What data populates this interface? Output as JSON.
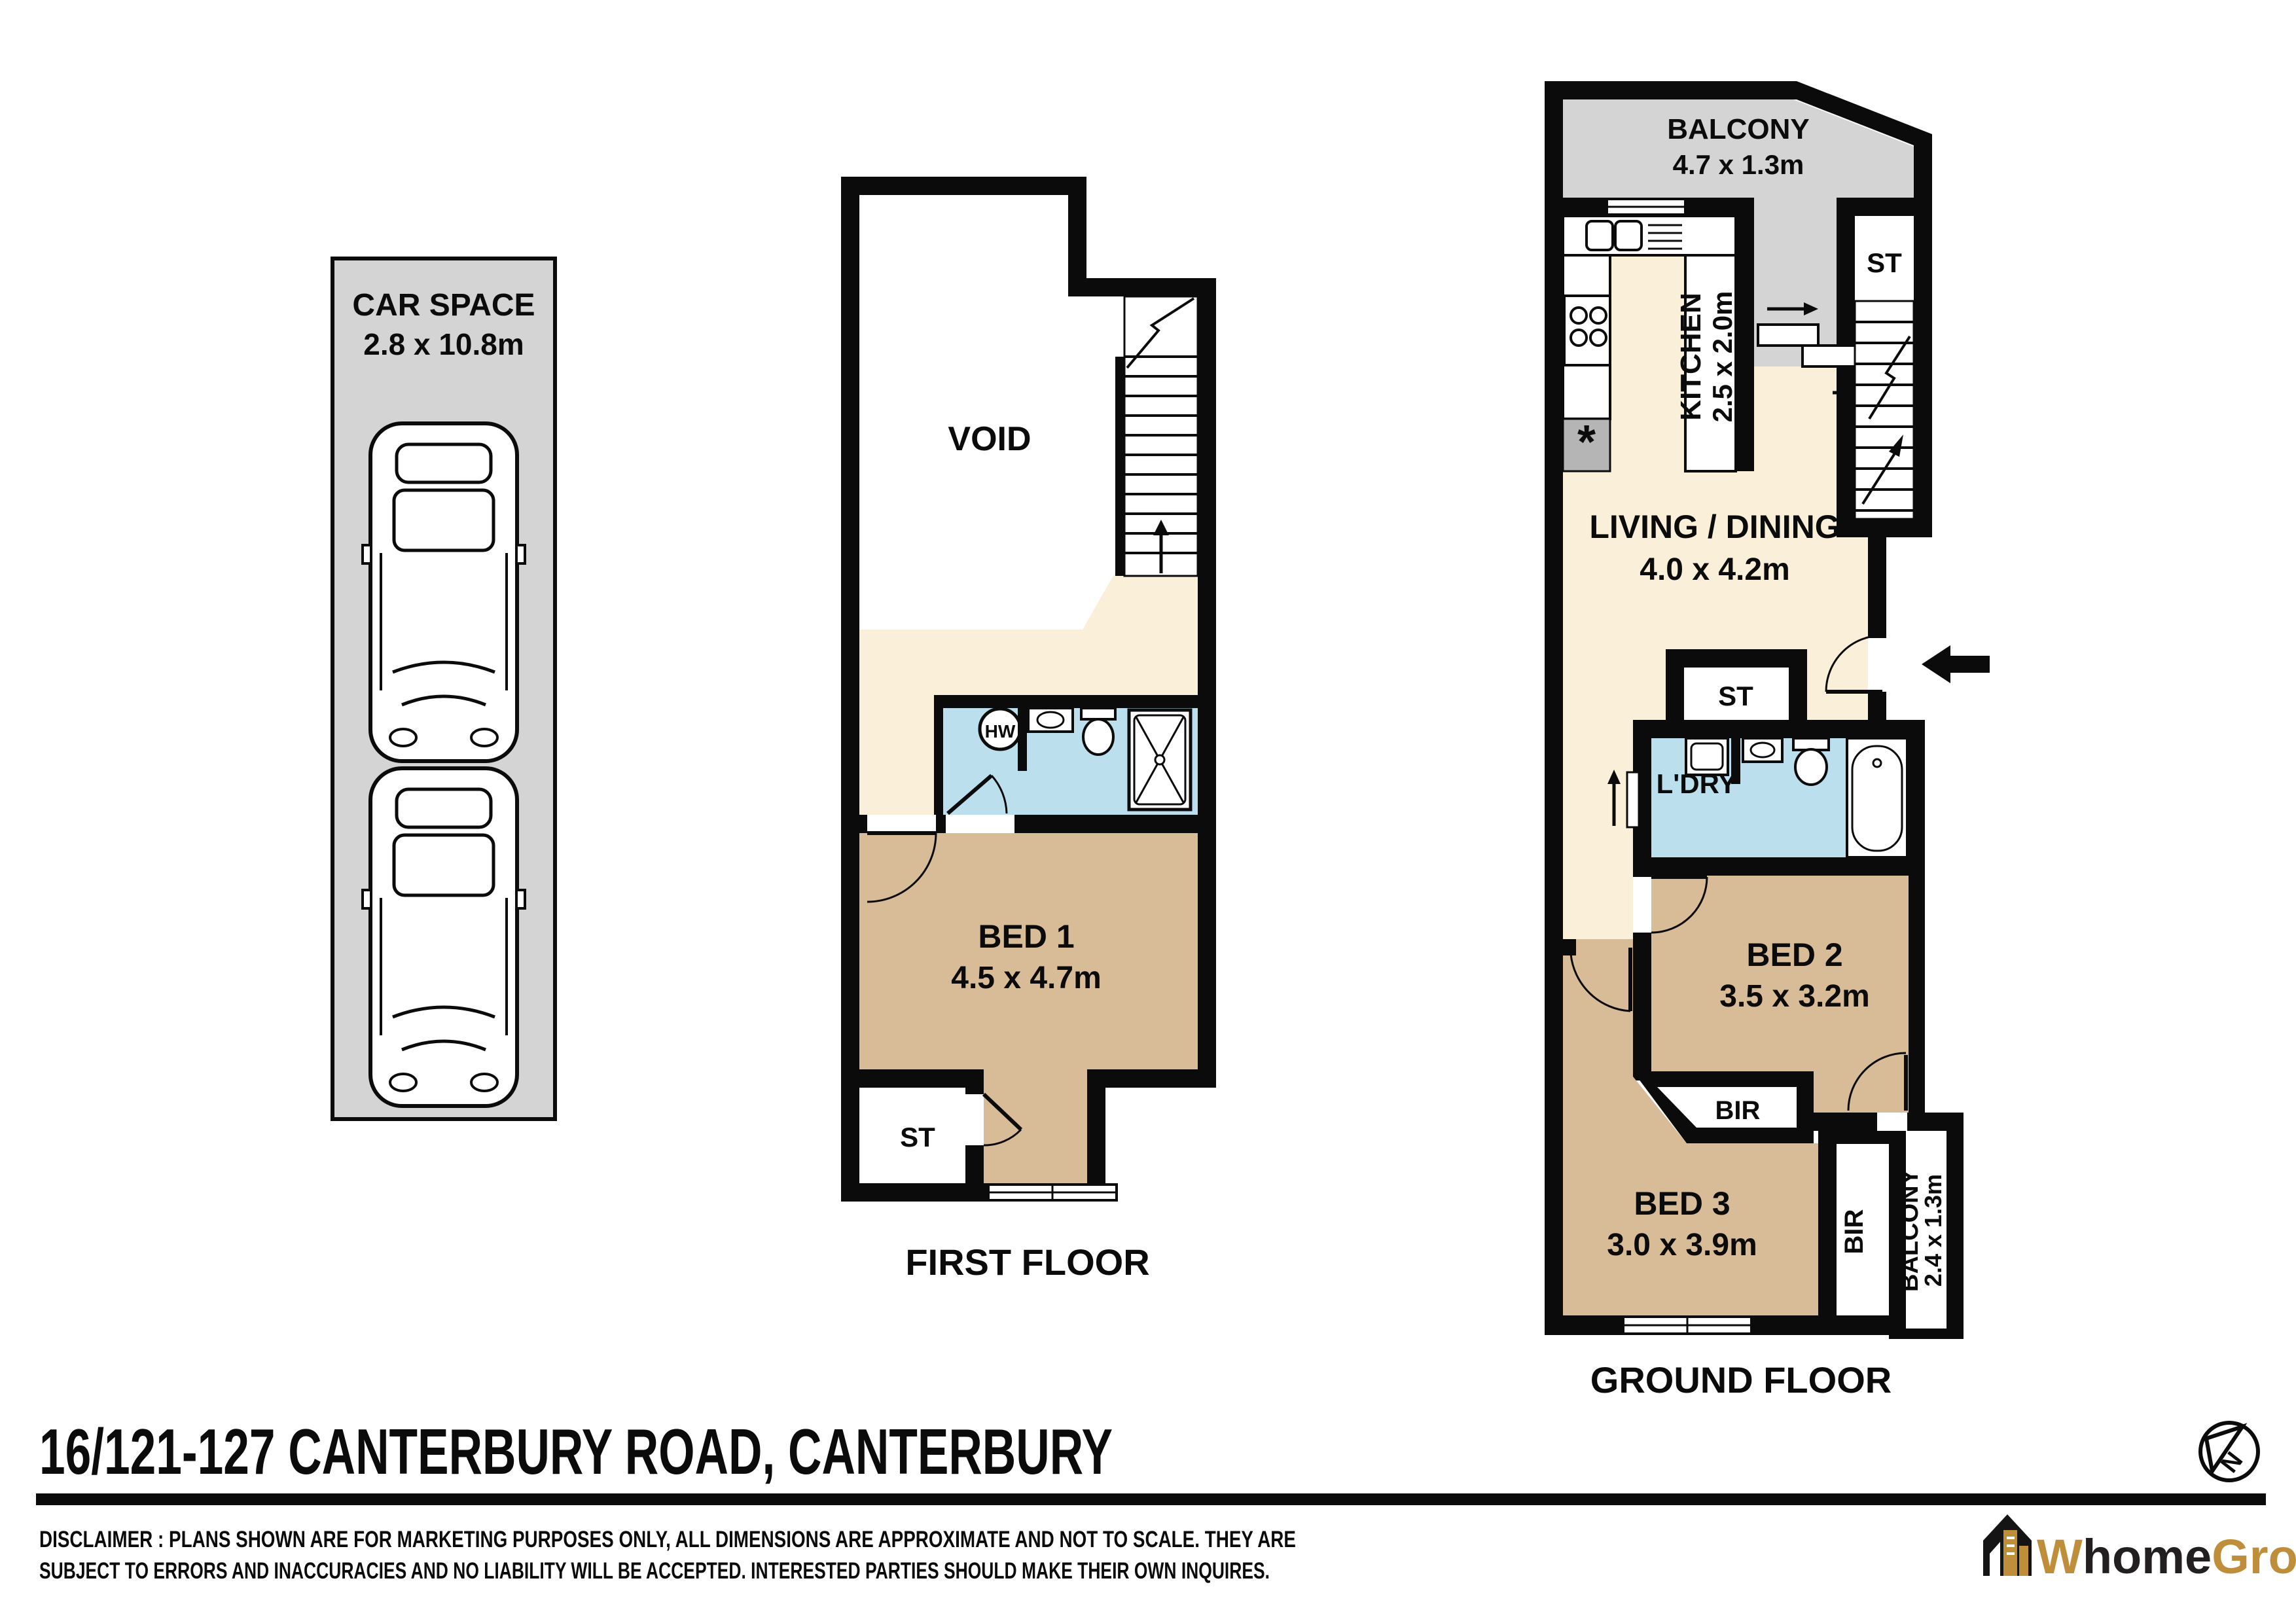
{
  "title": "16/121-127 CANTERBURY ROAD, CANTERBURY",
  "disclaimer": {
    "line1": "DISCLAIMER :   PLANS SHOWN ARE FOR MARKETING PURPOSES ONLY,  ALL DIMENSIONS ARE APPROXIMATE AND NOT TO SCALE.  THEY ARE",
    "line2": "SUBJECT TO ERRORS AND INACCURACIES AND NO LIABILITY WILL BE ACCEPTED. INTERESTED PARTIES SHOULD MAKE THEIR OWN INQUIRES."
  },
  "car_space": {
    "name": "CAR SPACE",
    "dims": "2.8 x 10.8m"
  },
  "first_floor": {
    "caption": "FIRST FLOOR",
    "void": "VOID",
    "bed1": {
      "name": "BED 1",
      "dims": "4.5 x 4.7m"
    },
    "st": "ST",
    "hw": "HW"
  },
  "ground_floor": {
    "caption": "GROUND FLOOR",
    "balcony_front": {
      "name": "BALCONY",
      "dims": "4.7 x 1.3m"
    },
    "kitchen": {
      "name": "KITCHEN",
      "dims": "2.5 x 2.0m"
    },
    "st_upper": "ST",
    "living": {
      "name": "LIVING / DINING",
      "dims": "4.0 x 4.2m"
    },
    "st_lower": "ST",
    "laundry": "L'DRY",
    "bed2": {
      "name": "BED 2",
      "dims": "3.5 x 3.2m"
    },
    "bir_bed2": "BIR",
    "bed3": {
      "name": "BED 3",
      "dims": "3.0 x 3.9m"
    },
    "bir_bed3": "BIR",
    "balcony_rear": {
      "name": "BALCONY",
      "dims": "2.4 x 1.3m"
    }
  },
  "compass": {
    "north": "N"
  },
  "logo": {
    "part1": "W",
    "part2": "home",
    "part3": "Group"
  },
  "colors": {
    "floor_cream": "#FAF0DA",
    "room_tan": "#D8BB97",
    "wet_blue": "#BCDFEE",
    "outdoor_gray": "#D4D4D4",
    "wall_black": "#0B0B0B",
    "logo_gold": "#BF8E3B",
    "logo_dark": "#231F20"
  }
}
